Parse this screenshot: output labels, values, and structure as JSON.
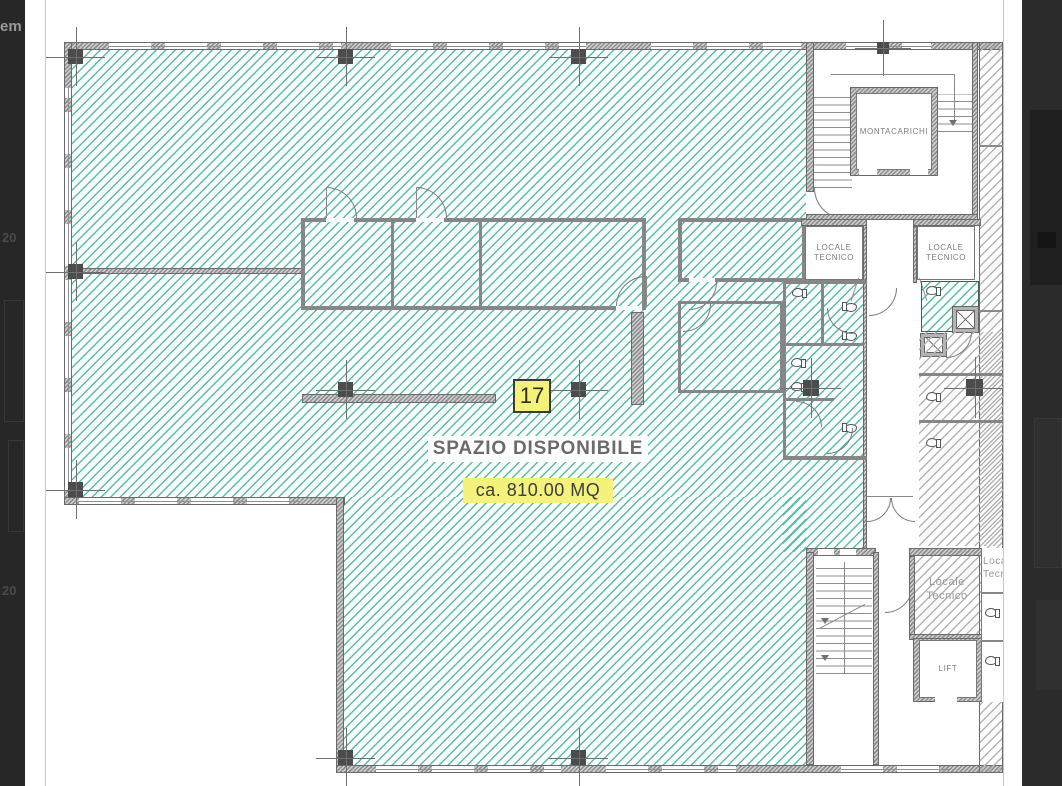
{
  "lightbox": {
    "word_fragment": "em",
    "number_top": "20",
    "number_bottom": "20"
  },
  "plan": {
    "unit_badge": "17",
    "availability_title": "SPAZIO DISPONIBILE",
    "availability_area": "ca. 810.00 MQ",
    "room_labels": {
      "montacarichi": "MONTACARICHI",
      "locale_tecnico_left": "LOCALE TECNICO",
      "locale_tecnico_right": "LOCALE TECNICO",
      "locale_tecnico_lower": "Locale Tecnico",
      "locale_tecnico_edge": "Locale Tecnico",
      "lift": "LIFT"
    },
    "colors": {
      "hatch_teal": "#55C09A",
      "highlight_yellow": "#F5F27B",
      "wall_gray": "#BDBDBD",
      "label_gray": "#7C7C7C",
      "overlay_dark": "#272727"
    }
  }
}
